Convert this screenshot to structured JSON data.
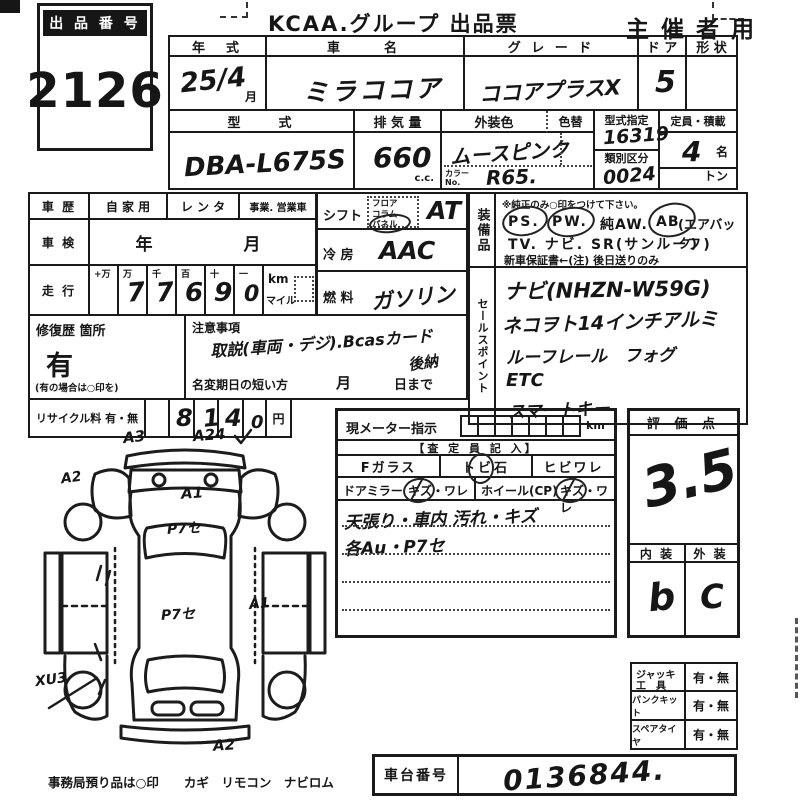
{
  "header": {
    "lot_label": "出 品 番 号",
    "lot_number": "2126",
    "title": "KCAA.グループ 出品票",
    "audience": "主 催 者 用"
  },
  "vehicle": {
    "year_label": "年　式",
    "year_value": "25/4",
    "month_suffix": "月",
    "name_label": "車　　名",
    "name_value": "ミラココア",
    "grade_label": "グ レ ー ド",
    "grade_value": "ココアプラスX",
    "door_label": "ド ア",
    "door_value": "5",
    "shape_label": "形 状",
    "model_label": "型　　式",
    "model_value": "DBA-L675S",
    "displacement_label": "排 気 量",
    "displacement_value": "660",
    "displacement_unit": "c.c.",
    "ext_color_label": "外装色",
    "ext_color_value": "ムースピンク",
    "color_change_label": "色替",
    "color_no_label": "カラーNo.",
    "color_no_value": "R65.",
    "type_designation_label": "型式指定",
    "type_designation_value": "16319",
    "classification_label": "類別区分",
    "classification_value": "0024",
    "capacity_label": "定員・積載",
    "capacity_value": "4",
    "capacity_unit": "名",
    "load_unit": "トン"
  },
  "history": {
    "label": "車 歴",
    "options": [
      "自 家 用",
      "レ ン タ",
      "事業. 営業車"
    ],
    "inspection_label": "車 検",
    "inspection_value": "年　　　月",
    "mileage_label": "走 行",
    "digit_headers": [
      "+万",
      "万",
      "千",
      "百",
      "十",
      "一"
    ],
    "digits": [
      "",
      "7",
      "7",
      "6",
      "9",
      "0"
    ],
    "unit_km": "km",
    "unit_mile": "マイル",
    "repair_label": "修復歴 箇所",
    "repair_value": "有",
    "repair_note": "(有の場合は○印を)",
    "recycle_label": "リサイクル料 有・無",
    "recycle_digits": [
      "",
      "8",
      "1",
      "4",
      "0"
    ],
    "recycle_unit": "円"
  },
  "controls": {
    "shift_label": "シフト",
    "shift_options": [
      "フロア",
      "コラム",
      "パネル"
    ],
    "shift_value": "AT",
    "ac_label": "冷 房",
    "ac_value": "AAC",
    "fuel_label": "燃 料",
    "fuel_value": "ガソリン"
  },
  "caution": {
    "label": "注意事項",
    "value": "取説(車両・デジ).Bcasカード",
    "value2": "後納",
    "rename_label": "名変期日の短い方",
    "rename_month": "月",
    "rename_day": "日まで"
  },
  "equipment": {
    "label": "装備品",
    "note": "※純正のみ○印をつけて下さい。",
    "tokens": [
      "PS.",
      "PW.",
      "純AW.",
      "AB",
      "(エアバック)"
    ],
    "line2": "TV. ナビ. SR(サンルーフ)",
    "line3": "新車保証書←(注) 後日送りのみ"
  },
  "sales_points": {
    "label": "セールスポイント",
    "lines": [
      "ナビ(NHZN-W59G)",
      "ネコヲト14インチアルミ",
      "ルーフレール　フォグ",
      "ETC",
      "スマートキー"
    ]
  },
  "meter": {
    "label": "現メーター指示",
    "unit": "km",
    "assessor_header": "【査 定 員 記 入】",
    "f_glass": "Fガラス",
    "stone_chip": "トビ石",
    "crack": "ヒビワレ",
    "door_mirror": "ドアミラー",
    "mirror_damage": "キズ・ワレ",
    "wheel": "ホイール(CP)",
    "wheel_damage": "キズ・ワレ",
    "notes": [
      "天張り・車内 汚れ・キズ",
      "各Au・P7セ"
    ]
  },
  "rating": {
    "label": "評 価 点",
    "score": "3.5",
    "interior_label": "内 装",
    "exterior_label": "外 装",
    "interior_value": "b",
    "exterior_value": "C"
  },
  "tools": {
    "jack_label": "ジャッキ",
    "jack_label2": "工　具",
    "jack_value": "有・無",
    "puncture_label": "パンクキット",
    "puncture_value": "有・無",
    "spare_label": "スペアタイヤ",
    "spare_value": "有・無"
  },
  "footer": {
    "office_note": "事務局預り品は○印　　カギ　リモコン　ナビロム",
    "vin_label": "車台番号",
    "vin_value": "0136844."
  },
  "diagram": {
    "annotations": {
      "front_left": "A3",
      "front_right": "A24",
      "left_fender": "A2",
      "hood": "A1",
      "windshield": "P7セ",
      "roof": "P7セ",
      "right_quarter": "A1",
      "left_rear_wheel": "XU3",
      "rear_bumper": "A2"
    }
  }
}
